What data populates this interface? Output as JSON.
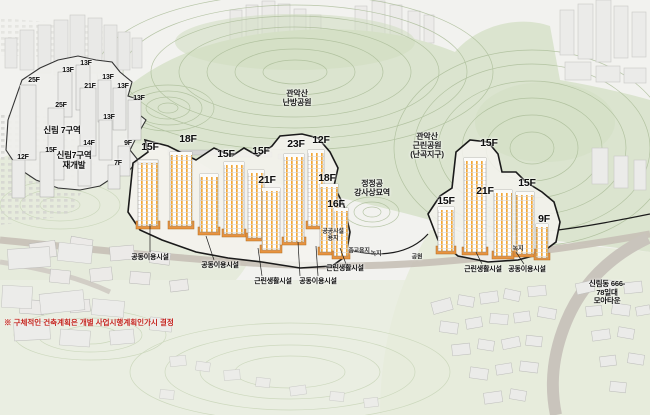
{
  "scene_type": "aerial-3d-site-rendering",
  "floors_site": [
    "15F",
    "18F",
    "15F",
    "15F",
    "21F",
    "23F",
    "12F",
    "18F",
    "16F",
    "15F",
    "21F",
    "15F",
    "15F",
    "9F"
  ],
  "floors_adjacent": [
    "25F",
    "13F",
    "13F",
    "21F",
    "13F",
    "13F",
    "13F",
    "25F",
    "13F",
    "14F",
    "9F",
    "15F",
    "12F",
    "7F"
  ],
  "labels": {
    "district_left": "신림 7구역",
    "district_left_sub": "신림7구역\n재개발",
    "site_area": "신림동 666-78일대\n모아타운",
    "park_center": "관악산\n난방공원",
    "park_right": "관악산\n근린공원\n(난곡지구)",
    "heritage": "정정공\n강사상묘역",
    "note": "※ 구체적인 건축계획은 개별 사업시행계획인가시 결정"
  },
  "facilities": [
    "공동이용시설",
    "공동이용시설",
    "근린생활시설",
    "공동이용시설",
    "근린생활시설",
    "근린생활시설",
    "공동이용시설"
  ],
  "land_use": [
    "공공시설\n용지",
    "종교용지",
    "녹지",
    "공원",
    "녹지"
  ],
  "colors": {
    "terrain_green": "#dbe4cf",
    "contour_line": "#a9bb96",
    "tower_stripe_orange": "#f2a93b",
    "podium_orange": "#e8933f",
    "boundary_black": "#1a1a1a",
    "note_red": "#c4231d",
    "road_gray": "#c7c0b6",
    "building_gray": "#ebebe9"
  }
}
